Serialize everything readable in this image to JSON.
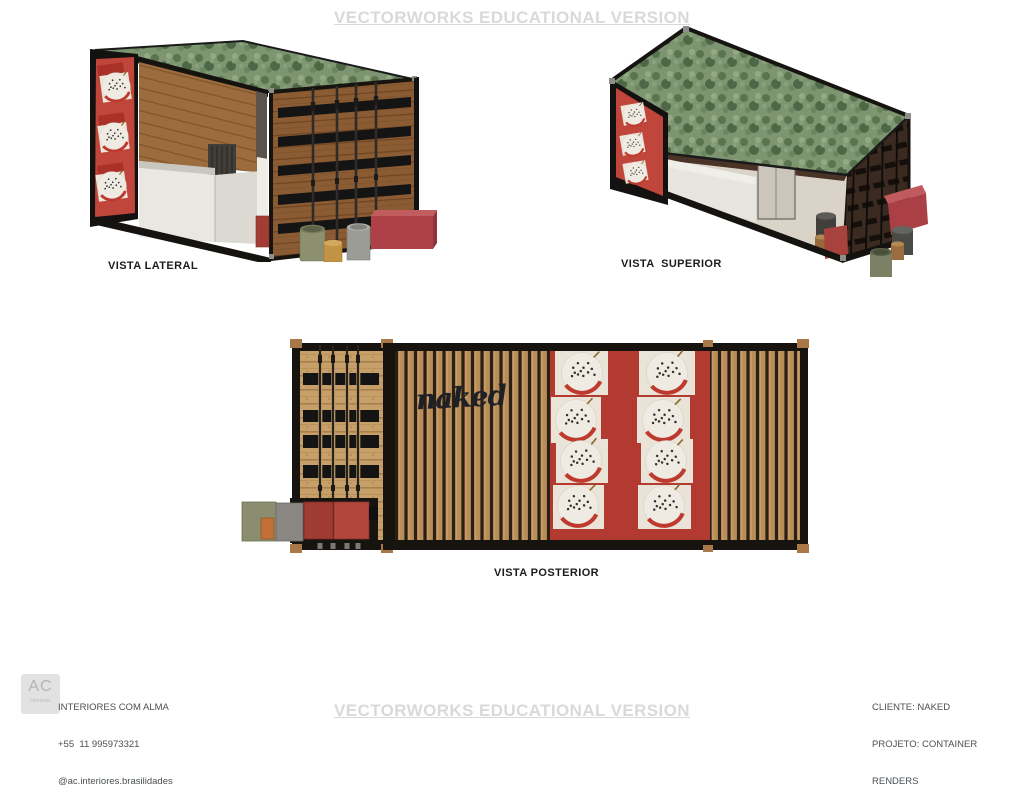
{
  "watermark": {
    "text": "VECTORWORKS EDUCATIONAL VERSION",
    "color": "#d9d9d9"
  },
  "views": {
    "lateral": {
      "label": "VISTA LATERAL"
    },
    "superior": {
      "label": "VISTA  SUPERIOR"
    },
    "posterior": {
      "label": "VISTA POSTERIOR",
      "sign_text": "naked"
    }
  },
  "footer": {
    "logo": {
      "initials": "AC",
      "subtext": "interiores"
    },
    "left_lines": [
      "INTERIORES COM ALMA",
      "+55  11 995973321",
      "@ac.interiores.brasilidades"
    ],
    "right_lines": [
      "CLIENTE: NAKED",
      "PROJETO: CONTAINER",
      "RENDERS"
    ]
  },
  "colors": {
    "frame_black": "#17130f",
    "roof_green": "#7d9671",
    "panel_red": "#b23a30",
    "wood_door": "#8b5c33",
    "wood_slat": "#b78d58",
    "wood_pine": "#c79f68",
    "counter_white": "#e9e7e2",
    "corner_casting_tan": "#a87848"
  }
}
